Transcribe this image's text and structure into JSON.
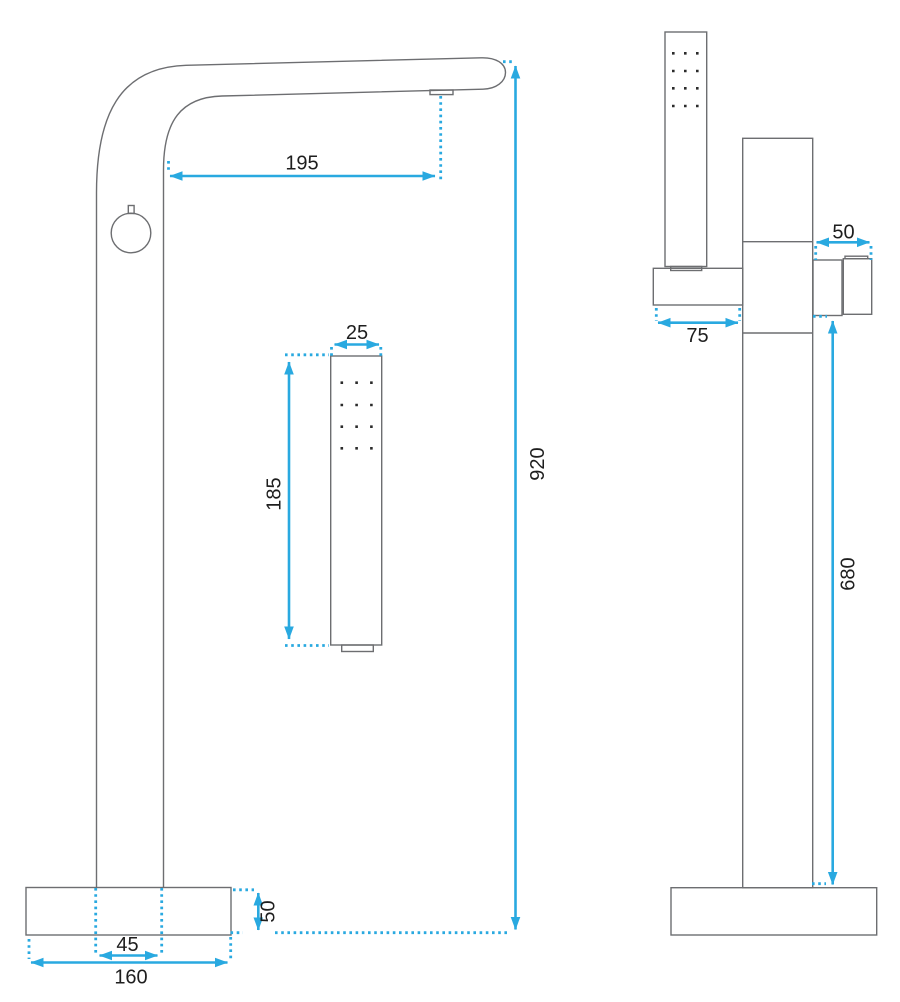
{
  "drawing": {
    "type": "technical-dimension-drawing",
    "subject": "freestanding-bathtub-mixer-tap",
    "units": "mm"
  },
  "colors": {
    "dimension": "#29A9E0",
    "outline": "#6D6E71",
    "label": "#1E1E1E",
    "background": "#FFFFFF",
    "shower_holes": "#2B2B2B"
  },
  "views": {
    "front": {
      "dimensions": {
        "spout_reach": "195",
        "handshower_width": "25",
        "handshower_length": "185",
        "total_height": "920",
        "base_thickness": "50",
        "column_width": "45",
        "base_width": "160"
      }
    },
    "side": {
      "dimensions": {
        "spout_length": "50",
        "bracket_reach": "75",
        "spout_height": "680"
      }
    }
  }
}
